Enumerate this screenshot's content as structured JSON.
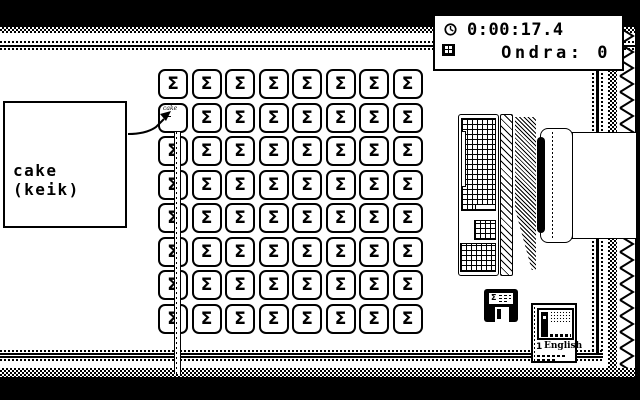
{
  "hud": {
    "time": "0:00:17.4",
    "score": "Ondra: 0"
  },
  "word_card": {
    "word": "cake",
    "phonetic": "(keik)"
  },
  "board": {
    "rows": 8,
    "cols": 8,
    "tile_symbol": "Σ",
    "flipped": {
      "row": 1,
      "col": 0,
      "mini_word": "cake"
    }
  },
  "floppy": {
    "label": "Σ"
  },
  "lesson_card": {
    "number": "1",
    "title": "English"
  },
  "colors": {
    "ink": "#000000",
    "paper": "#ffffff"
  }
}
